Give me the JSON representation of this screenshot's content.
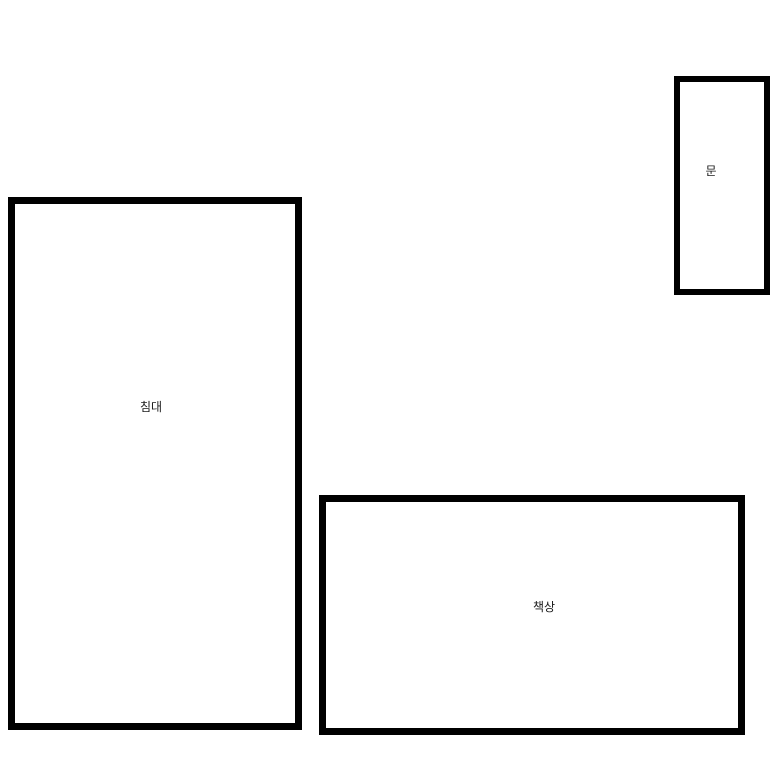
{
  "diagram": {
    "type": "floor-plan",
    "background_color": "#ffffff",
    "stroke_color": "#000000",
    "label_color": "#1a1a1a",
    "shapes": [
      {
        "id": "bed",
        "label": "침대",
        "x": 8,
        "y": 197,
        "width": 294,
        "height": 533
      },
      {
        "id": "desk",
        "label": "책상",
        "x": 319,
        "y": 495,
        "width": 426,
        "height": 240
      },
      {
        "id": "door",
        "label": "문",
        "x": 674,
        "y": 76,
        "width": 96,
        "height": 219
      }
    ]
  }
}
